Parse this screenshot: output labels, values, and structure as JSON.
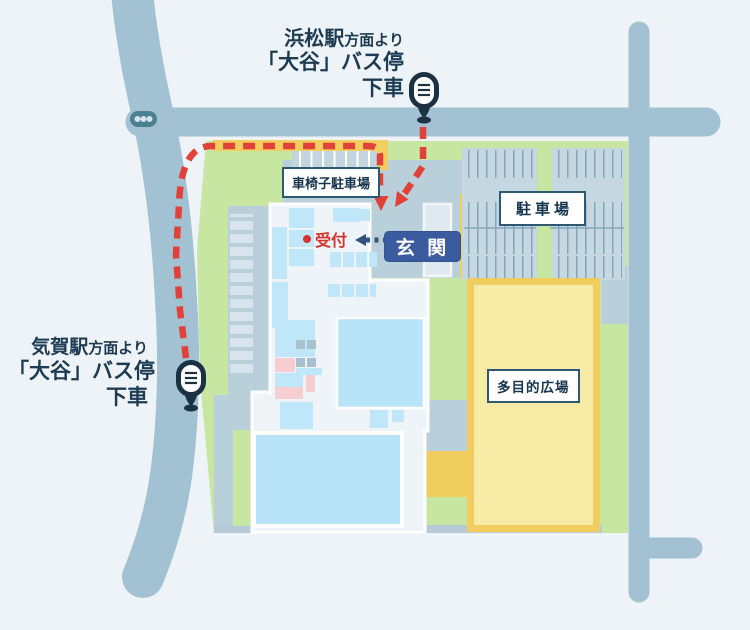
{
  "title": "facility access map",
  "route_top": {
    "station": "浜松駅",
    "via": "方面より",
    "line2": "「大谷」バス停",
    "line3": "下車"
  },
  "route_left": {
    "station": "気賀駅",
    "via": "方面より",
    "line2": "「大谷」バス停",
    "line3": "下車"
  },
  "areas": {
    "wheelchair_parking": "車椅子駐車場",
    "parking": "駐車場",
    "plaza": "多目的広場"
  },
  "entrance": {
    "label": "玄 関"
  },
  "reception": {
    "label": "受付"
  },
  "icons": [
    "bus-stop-icon-top",
    "bus-stop-icon-left",
    "traffic-light-icon"
  ],
  "colors": {
    "background": "#edf3f7",
    "road": "#a2c1d2",
    "site_green": "#c7e6a1",
    "sidewalk_yellow": "#f2ce5f",
    "plaza_fill": "#f8eba6",
    "plaza_border": "#f0cd5e",
    "concrete_grey": "#b9cfda",
    "parking_grey": "#c5d7e1",
    "stall_line": "#84a5ba",
    "building_floor": "#eef4f8",
    "room_blue": "#bfe6f9",
    "hall_blue": "#b9e3f8",
    "room_pink": "#f6ced2",
    "room_grey": "#a8c0cf",
    "route_red": "#e2413a",
    "entrance_badge_blue": "#3a5c9e",
    "arrow_blue": "#35527f",
    "reception_red": "#d6332c",
    "bus_icon_navy": "#1b3243",
    "traffic_light_teal": "#4b7f92",
    "text_navy": "#1d3b52"
  }
}
